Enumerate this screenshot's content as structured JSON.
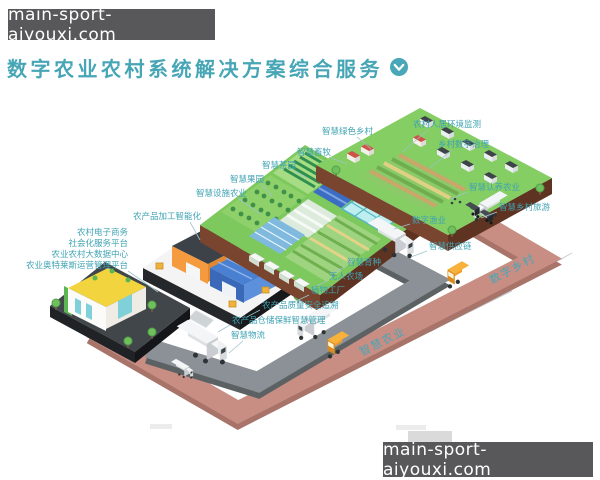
{
  "watermarks": {
    "top_left": "main-sport-aiyouxi.com",
    "bottom_right": "main-sport-aiyouxi.com"
  },
  "header": {
    "title": "数字农业农村系统解决方案综合服务",
    "expand_icon": "chevron-down-icon"
  },
  "diagram": {
    "callouts": [
      {
        "id": "rural-env-monitoring",
        "text": "农村人居环境监测"
      },
      {
        "id": "village-digital-governance",
        "text": "乡村数字治理"
      },
      {
        "id": "smart-green-village",
        "text": "智慧绿色乡村"
      },
      {
        "id": "smart-livestock",
        "text": "智慧畜牧"
      },
      {
        "id": "smart-tea-garden",
        "text": "智慧茶园"
      },
      {
        "id": "smart-orchard",
        "text": "智慧果园"
      },
      {
        "id": "smart-facility-agriculture",
        "text": "智慧设施农业"
      },
      {
        "id": "agri-product-processing",
        "text": "农产品加工智能化"
      },
      {
        "id": "rural-ecommerce",
        "text": "农村电子商务"
      },
      {
        "id": "social-service-platform",
        "text": "社会化服务平台"
      },
      {
        "id": "agri-rural-big-data-center",
        "text": "农业农村大数据中心"
      },
      {
        "id": "agri-outlets-operation-platform",
        "text": "农业奥特莱斯运营管理平台"
      },
      {
        "id": "smart-breeding",
        "text": "智慧育种"
      },
      {
        "id": "unmanned-farm",
        "text": "无人农场"
      },
      {
        "id": "plant-factory",
        "text": "植物工厂"
      },
      {
        "id": "quality-safety-traceability",
        "text": "农产品质量安全追溯"
      },
      {
        "id": "storage-preservation-management",
        "text": "农产品仓储保鲜智慧管理"
      },
      {
        "id": "smart-logistics",
        "text": "智慧物流"
      },
      {
        "id": "digital-fishery",
        "text": "数字渔业"
      },
      {
        "id": "smart-supply-chain",
        "text": "智慧供应链"
      },
      {
        "id": "smart-adoption-agriculture",
        "text": "智慧认养农业"
      },
      {
        "id": "smart-village-tourism",
        "text": "智慧乡村旅游"
      }
    ],
    "road_labels": [
      {
        "id": "smart-agriculture-road",
        "text": "智慧农业"
      },
      {
        "id": "digital-village-road",
        "text": "数字乡村"
      }
    ],
    "scene_elements": [
      "village-platform",
      "farm-platform",
      "factory-platform",
      "store-platform",
      "gray-road",
      "pink-road",
      "box-trucks",
      "shuttle-buses"
    ]
  },
  "colors": {
    "accent_teal": "#3fa3b3",
    "title_teal": "#47a6b6",
    "watermark_bg": "#58585a",
    "road_pink": "#c88e84",
    "road_gray": "#8b9196",
    "platform_green": "#7ec95e",
    "platform_soil": "#79452f",
    "building_orange": "#f59a3f",
    "building_blue": "#4a80d2",
    "building_yellow": "#f2d53e"
  }
}
